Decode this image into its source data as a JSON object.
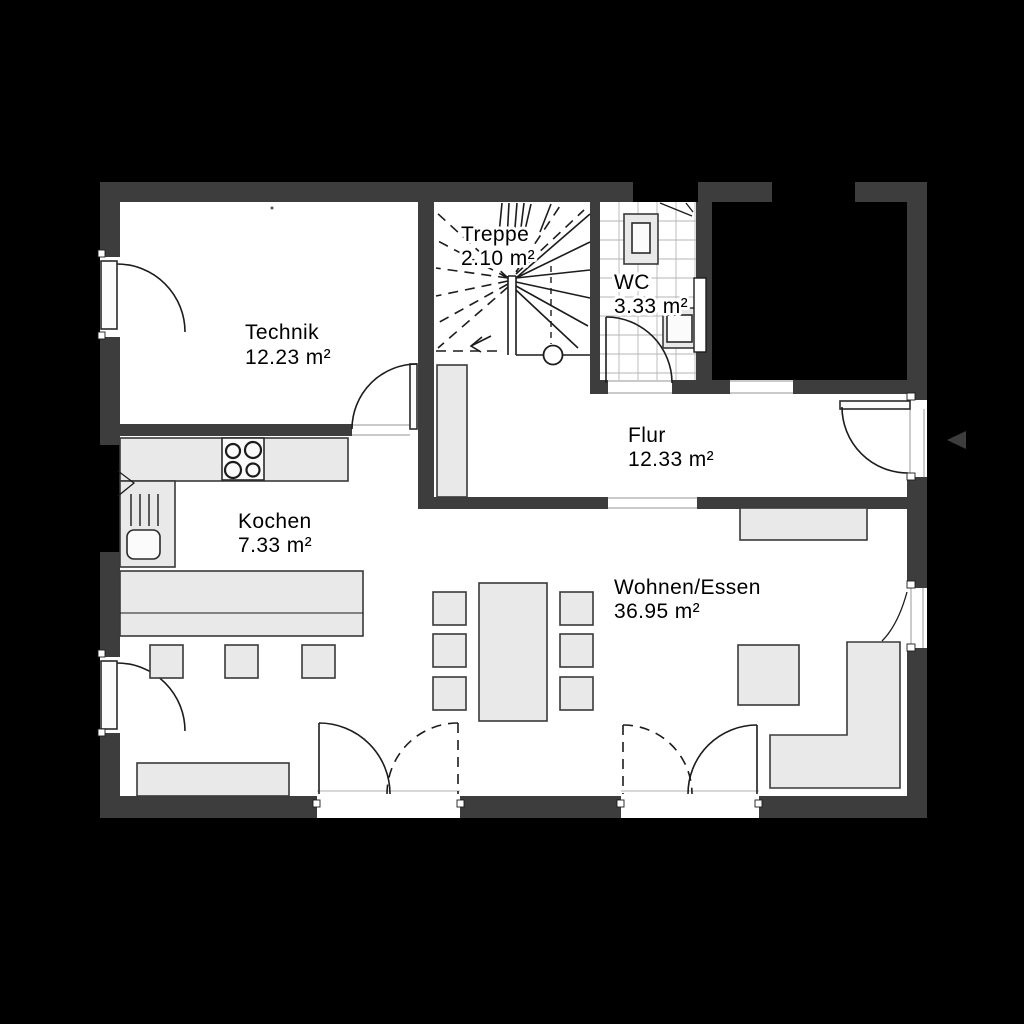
{
  "plan": {
    "type": "floor-plan",
    "colors": {
      "background": "#000000",
      "wall": "#3d3d3d",
      "floor": "#ffffff",
      "furniture": "#e9e9e9",
      "line": "#1c1c1c"
    },
    "icons": {
      "entrance_arrow": "left-triangle"
    },
    "rooms": {
      "technik": {
        "name": "Technik",
        "area": "12.23 m²"
      },
      "treppe": {
        "name": "Treppe",
        "area": "2.10 m²"
      },
      "wc": {
        "name": "WC",
        "area": "3.33 m²"
      },
      "flur": {
        "name": "Flur",
        "area": "12.33 m²"
      },
      "kochen": {
        "name": "Kochen",
        "area": "7.33 m²"
      },
      "wohnen_essen": {
        "name": "Wohnen/Essen",
        "area": "36.95 m²"
      }
    }
  }
}
